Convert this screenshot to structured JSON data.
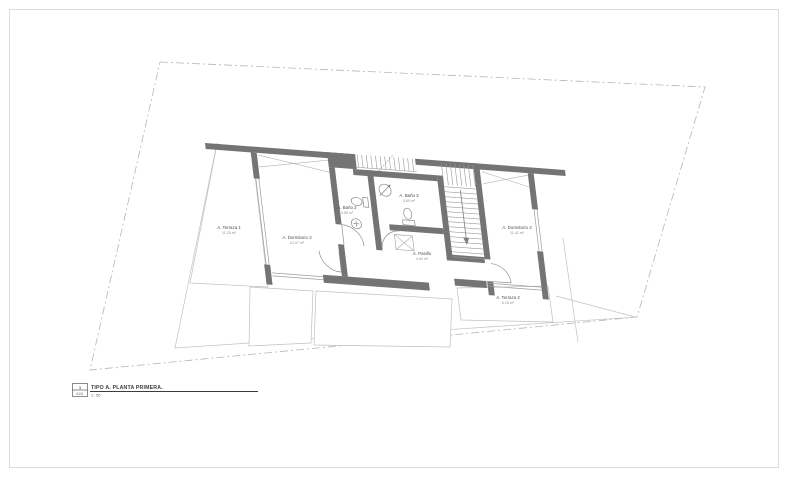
{
  "page": {
    "background": "#ffffff",
    "border_color": "#dcdcdc"
  },
  "drawing": {
    "type": "architectural-floor-plan",
    "rooms": [
      {
        "id": "terraza-1",
        "name": "A. Terraza 1",
        "area": "11.25 m²"
      },
      {
        "id": "dormitorio-2",
        "name": "A. Dormitorio 2",
        "area": "12.07 m²"
      },
      {
        "id": "bano-2",
        "name": "A. Baño 2",
        "area": "3.55 m²"
      },
      {
        "id": "bano-3",
        "name": "A. Baño 3",
        "area": "3.60 m²"
      },
      {
        "id": "pasillo",
        "name": "A. Pasillo",
        "area": "4.40 m²"
      },
      {
        "id": "dormitorio-3",
        "name": "A. Dormitorio 3",
        "area": "11.42 m²"
      },
      {
        "id": "terraza-2",
        "name": "A. Terraza 2",
        "area": "5.15 m²"
      }
    ],
    "colors": {
      "wall": "#747474",
      "thin_line": "#9c9c9c",
      "boundary_dash": "#b6b6b6",
      "text": "#4d4d4d"
    }
  },
  "title_block": {
    "view_number": "1",
    "sheet_ref": "A101",
    "title": "TIPO A. PLANTA PRIMERA.",
    "scale": "1 : 50"
  }
}
